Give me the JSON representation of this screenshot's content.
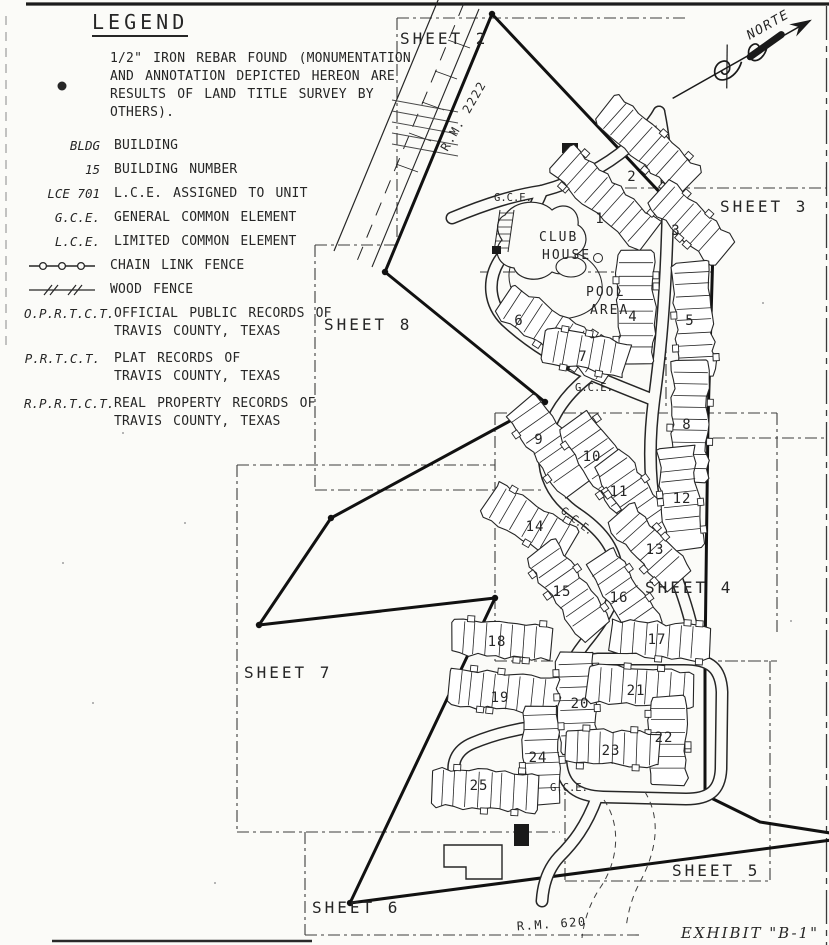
{
  "page": {
    "paper_color": "#fbfbf8",
    "ink_color": "#262626"
  },
  "legend": {
    "title": "LEGEND",
    "items": [
      {
        "symbol": "rebar-point",
        "term": "",
        "lines": [
          "1/2\" IRON REBAR FOUND (MONUMENTATION",
          "AND ANNOTATION DEPICTED HEREON ARE",
          "RESULTS OF LAND TITLE SURVEY BY OTHERS)."
        ]
      },
      {
        "symbol": "term",
        "term": "BLDG",
        "lines": [
          "BUILDING"
        ]
      },
      {
        "symbol": "term",
        "term": "15",
        "lines": [
          "BUILDING NUMBER"
        ]
      },
      {
        "symbol": "term",
        "term": "LCE 701",
        "lines": [
          "L.C.E. ASSIGNED TO UNIT"
        ]
      },
      {
        "symbol": "term",
        "term": "G.C.E.",
        "lines": [
          "GENERAL COMMON ELEMENT"
        ]
      },
      {
        "symbol": "term",
        "term": "L.C.E.",
        "lines": [
          "LIMITED COMMON ELEMENT"
        ]
      },
      {
        "symbol": "chain-link-fence",
        "term": "",
        "lines": [
          "CHAIN LINK FENCE"
        ]
      },
      {
        "symbol": "wood-fence",
        "term": "",
        "lines": [
          "WOOD FENCE"
        ]
      },
      {
        "symbol": "term",
        "term": "O.P.R.T.C.T.",
        "lines": [
          "OFFICIAL PUBLIC RECORDS OF",
          "TRAVIS COUNTY, TEXAS"
        ]
      },
      {
        "symbol": "term",
        "term": "P.R.T.C.T.",
        "lines": [
          "PLAT RECORDS OF",
          "TRAVIS COUNTY, TEXAS"
        ]
      },
      {
        "symbol": "term",
        "term": "R.P.R.T.C.T.",
        "lines": [
          "REAL PROPERTY RECORDS OF",
          "TRAVIS COUNTY, TEXAS"
        ]
      }
    ]
  },
  "map": {
    "north_label": "NORTE",
    "exhibit_label": "EXHIBIT \"B-1\"",
    "sheet_labels": [
      {
        "text": "SHEET 2",
        "x": 400,
        "y": 44
      },
      {
        "text": "SHEET 3",
        "x": 720,
        "y": 212
      },
      {
        "text": "SHEET 8",
        "x": 324,
        "y": 330
      },
      {
        "text": "SHEET 4",
        "x": 645,
        "y": 593
      },
      {
        "text": "SHEET 7",
        "x": 244,
        "y": 678
      },
      {
        "text": "SHEET 5",
        "x": 672,
        "y": 876
      },
      {
        "text": "SHEET 6",
        "x": 312,
        "y": 913
      }
    ],
    "road_labels": [
      {
        "text": "R.M. 2222",
        "x": 467,
        "y": 118,
        "rotate": -60
      },
      {
        "text": "R.M. 620",
        "x": 552,
        "y": 928,
        "rotate": -4
      }
    ],
    "area_labels": [
      {
        "text": "CLUB",
        "x": 539,
        "y": 241
      },
      {
        "text": "HOUSE",
        "x": 542,
        "y": 259
      },
      {
        "text": "POOL",
        "x": 586,
        "y": 296
      },
      {
        "text": "AREA",
        "x": 590,
        "y": 314
      }
    ],
    "gce_labels": [
      {
        "text": "G.C.E.",
        "x": 494,
        "y": 201,
        "rotate": 0
      },
      {
        "text": "G.C.E.",
        "x": 575,
        "y": 391,
        "rotate": 0
      },
      {
        "text": "G.C.E.",
        "x": 560,
        "y": 512,
        "rotate": 38
      },
      {
        "text": "G.C.E.",
        "x": 550,
        "y": 791,
        "rotate": 0
      }
    ],
    "buildings": [
      {
        "n": "1",
        "cx": 605,
        "cy": 198,
        "len": 118,
        "wid": 36,
        "angle": 42,
        "lx": 600,
        "ly": 223
      },
      {
        "n": "2",
        "cx": 648,
        "cy": 146,
        "len": 112,
        "wid": 36,
        "angle": 42,
        "lx": 632,
        "ly": 181
      },
      {
        "n": "3",
        "cx": 690,
        "cy": 222,
        "len": 88,
        "wid": 34,
        "angle": 42,
        "lx": 676,
        "ly": 235
      },
      {
        "n": "4",
        "cx": 636,
        "cy": 308,
        "len": 110,
        "wid": 36,
        "angle": 90,
        "lx": 633,
        "ly": 321
      },
      {
        "n": "5",
        "cx": 694,
        "cy": 318,
        "len": 112,
        "wid": 36,
        "angle": 87,
        "lx": 690,
        "ly": 325
      },
      {
        "n": "6",
        "cx": 558,
        "cy": 334,
        "len": 125,
        "wid": 36,
        "angle": 33,
        "lx": 519,
        "ly": 325
      },
      {
        "n": "7",
        "cx": 585,
        "cy": 352,
        "len": 82,
        "wid": 34,
        "angle": 10,
        "lx": 583,
        "ly": 361
      },
      {
        "n": "8",
        "cx": 690,
        "cy": 420,
        "len": 118,
        "wid": 36,
        "angle": 91,
        "lx": 687,
        "ly": 429
      },
      {
        "n": "9",
        "cx": 550,
        "cy": 446,
        "len": 100,
        "wid": 38,
        "angle": 55,
        "lx": 539,
        "ly": 444
      },
      {
        "n": "10",
        "cx": 602,
        "cy": 462,
        "len": 102,
        "wid": 38,
        "angle": 55,
        "lx": 592,
        "ly": 461
      },
      {
        "n": "11",
        "cx": 636,
        "cy": 500,
        "len": 98,
        "wid": 36,
        "angle": 55,
        "lx": 619,
        "ly": 496
      },
      {
        "n": "12",
        "cx": 680,
        "cy": 497,
        "len": 100,
        "wid": 36,
        "angle": 84,
        "lx": 682,
        "ly": 503
      },
      {
        "n": "13",
        "cx": 650,
        "cy": 548,
        "len": 88,
        "wid": 34,
        "angle": 48,
        "lx": 655,
        "ly": 554
      },
      {
        "n": "14",
        "cx": 530,
        "cy": 522,
        "len": 94,
        "wid": 36,
        "angle": 30,
        "lx": 535,
        "ly": 531
      },
      {
        "n": "15",
        "cx": 568,
        "cy": 590,
        "len": 98,
        "wid": 36,
        "angle": 55,
        "lx": 562,
        "ly": 596
      },
      {
        "n": "16",
        "cx": 624,
        "cy": 594,
        "len": 88,
        "wid": 34,
        "angle": 55,
        "lx": 619,
        "ly": 602
      },
      {
        "n": "17",
        "cx": 660,
        "cy": 640,
        "len": 98,
        "wid": 34,
        "angle": 4,
        "lx": 657,
        "ly": 644
      },
      {
        "n": "18",
        "cx": 502,
        "cy": 640,
        "len": 98,
        "wid": 34,
        "angle": 4,
        "lx": 497,
        "ly": 646
      },
      {
        "n": "19",
        "cx": 505,
        "cy": 692,
        "len": 112,
        "wid": 36,
        "angle": 6,
        "lx": 500,
        "ly": 702
      },
      {
        "n": "20",
        "cx": 577,
        "cy": 702,
        "len": 98,
        "wid": 36,
        "angle": 88,
        "lx": 580,
        "ly": 708
      },
      {
        "n": "21",
        "cx": 640,
        "cy": 687,
        "len": 102,
        "wid": 36,
        "angle": 4,
        "lx": 636,
        "ly": 695
      },
      {
        "n": "22",
        "cx": 668,
        "cy": 740,
        "len": 86,
        "wid": 36,
        "angle": 90,
        "lx": 664,
        "ly": 742
      },
      {
        "n": "23",
        "cx": 612,
        "cy": 748,
        "len": 90,
        "wid": 34,
        "angle": 2,
        "lx": 611,
        "ly": 755
      },
      {
        "n": "24",
        "cx": 542,
        "cy": 754,
        "len": 96,
        "wid": 36,
        "angle": 88,
        "lx": 538,
        "ly": 762
      },
      {
        "n": "25",
        "cx": 484,
        "cy": 790,
        "len": 104,
        "wid": 38,
        "angle": 3,
        "lx": 479,
        "ly": 790
      }
    ]
  }
}
